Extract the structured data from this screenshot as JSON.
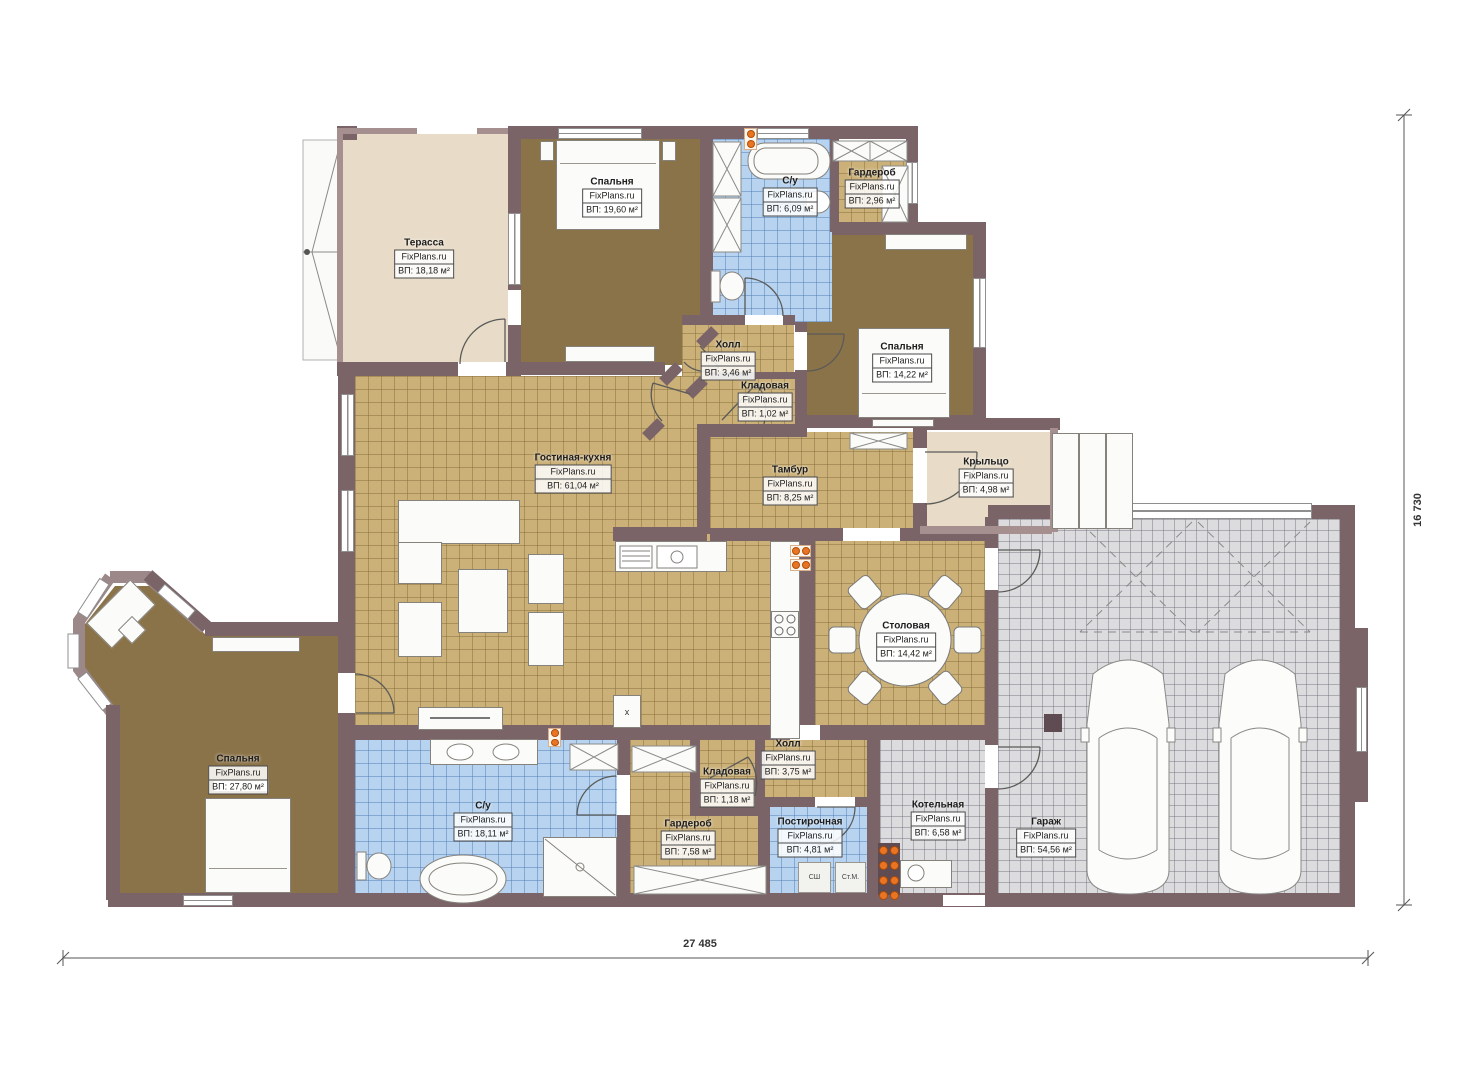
{
  "watermark": "FixPlans.ru",
  "dimensions": {
    "width_label": "27 485",
    "height_label": "16 730"
  },
  "appliances": {
    "dryer_label": "СШ",
    "washer_label": "Ст.М."
  },
  "symbols": {
    "column_mark": "x"
  },
  "rooms": [
    {
      "name": "Терасса",
      "area_label": "ВП: 18,18 м²"
    },
    {
      "name": "Спальня",
      "area_label": "ВП: 19,60 м²"
    },
    {
      "name": "С/у",
      "area_label": "ВП: 6,09 м²"
    },
    {
      "name": "Гардероб",
      "area_label": "ВП: 2,96 м²"
    },
    {
      "name": "Спальня",
      "area_label": "ВП: 14,22 м²"
    },
    {
      "name": "Холл",
      "area_label": "ВП: 3,46 м²"
    },
    {
      "name": "Кладовая",
      "area_label": "ВП: 1,02 м²"
    },
    {
      "name": "Гостиная-кухня",
      "area_label": "ВП: 61,04 м²"
    },
    {
      "name": "Тамбур",
      "area_label": "ВП: 8,25 м²"
    },
    {
      "name": "Крыльцо",
      "area_label": "ВП: 4,98 м²"
    },
    {
      "name": "Столовая",
      "area_label": "ВП: 14,42 м²"
    },
    {
      "name": "Гараж",
      "area_label": "ВП: 54,56 м²"
    },
    {
      "name": "Котельная",
      "area_label": "ВП: 6,58 м²"
    },
    {
      "name": "Спальня",
      "area_label": "ВП: 27,80 м²"
    },
    {
      "name": "С/у",
      "area_label": "ВП: 18,11 м²"
    },
    {
      "name": "Гардероб",
      "area_label": "ВП: 7,58 м²"
    },
    {
      "name": "Кладовая",
      "area_label": "ВП: 1,18 м²"
    },
    {
      "name": "Холл",
      "area_label": "ВП: 3,75 м²"
    },
    {
      "name": "Постирочная",
      "area_label": "ВП: 4,81 м²"
    }
  ]
}
